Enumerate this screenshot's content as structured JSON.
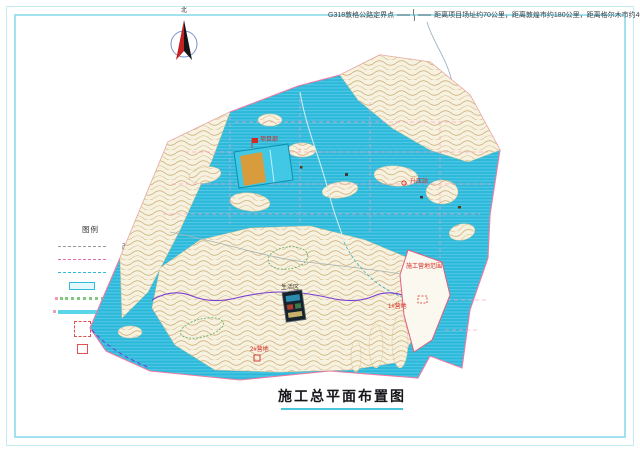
{
  "sheet": {
    "frame_color": "#a2e2ee",
    "background": "#ffffff"
  },
  "callout": {
    "left": "G318敦格公路定界点",
    "right": "距离项目场址约70公里，距离敦煌市约180公里，距离格尔木市约400公里。"
  },
  "north": {
    "label": "北"
  },
  "legend": {
    "title": "图例",
    "items": [
      {
        "label": "改建道路",
        "swatch": "dash-gray"
      },
      {
        "label": "新建道路",
        "swatch": "dash-magenta"
      },
      {
        "label": "现状道路",
        "swatch": "dash-cyan"
      },
      {
        "label": "固定式(2x10)",
        "swatch": "rect-cyan"
      },
      {
        "label": "大跨度支架(1x10)",
        "swatch": "dots-green"
      },
      {
        "label": "大跨度支架(2x10)",
        "swatch": "bar-cyan"
      },
      {
        "label": "施工营地",
        "swatch": "square-red-dashed"
      },
      {
        "label": "材料堆场",
        "swatch": "square-red"
      }
    ]
  },
  "map": {
    "labels": [
      {
        "text": "项目部"
      },
      {
        "text": "升压站"
      },
      {
        "text": "施工营地范围"
      },
      {
        "text": "1#营地"
      },
      {
        "text": "2#营地"
      },
      {
        "text": "生活区"
      }
    ]
  },
  "title": {
    "text": "施工总平面布置图"
  },
  "colors": {
    "pv_field": "#2cb8da",
    "boundary": "#ee7aa4",
    "terrain_line": "#c9a96f",
    "marker_red": "#d22a22",
    "route_purple": "#7a3fd0",
    "zone_green": "#5aa85a",
    "title_underline": "#4cc6da"
  }
}
